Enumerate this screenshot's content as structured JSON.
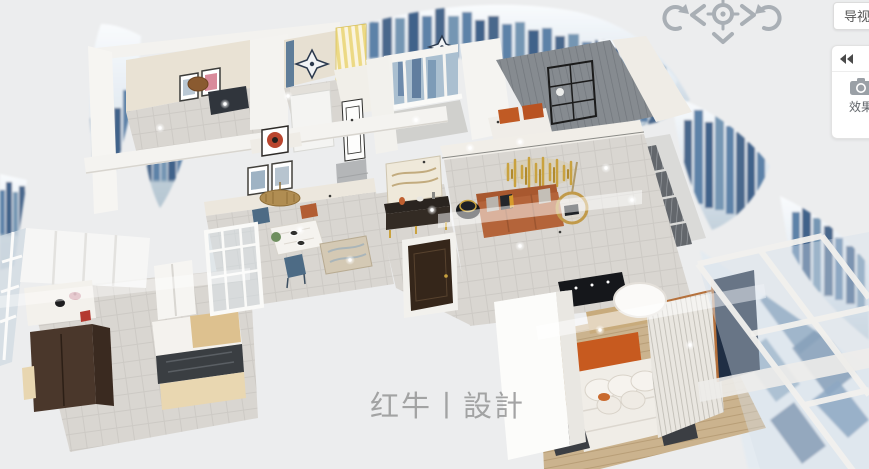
{
  "canvas": {
    "width": 869,
    "height": 469,
    "background": "#ecedee"
  },
  "viewport_controls": {
    "nav_view_button": "导视图",
    "compass_icons": [
      "rotate-ccw",
      "chevron-left",
      "orbit-target",
      "chevron-right",
      "rotate-cw",
      "chevron-down",
      "chevron-up"
    ]
  },
  "right_panel": {
    "collapse_icon": "double-chevron-left",
    "camera_icon": "camera",
    "effect_label": "效果"
  },
  "watermark": {
    "text": "红牛丨設計"
  },
  "palette": {
    "background": "#ecedee",
    "sofa_orange": "#b4643a",
    "headboard_orange": "#c75a1f",
    "accent_gold": "#c9a23f",
    "curtain_yellow": "#ecd984",
    "door_brown": "#35261a",
    "cabinet_brown": "#4a372b",
    "navy_panel": "#1f2e44",
    "skyline_blue": "#5d82a8",
    "floor_tile": "#d9d6d1",
    "floor_wood": "#cbb38e",
    "wall_white": "#f4f3f0",
    "wall_cream": "#e9e3d6",
    "dining_chair_blue": "#4d6b85",
    "island_wood": "#ddc18f",
    "ui_icon_gray": "#a9afb5"
  }
}
